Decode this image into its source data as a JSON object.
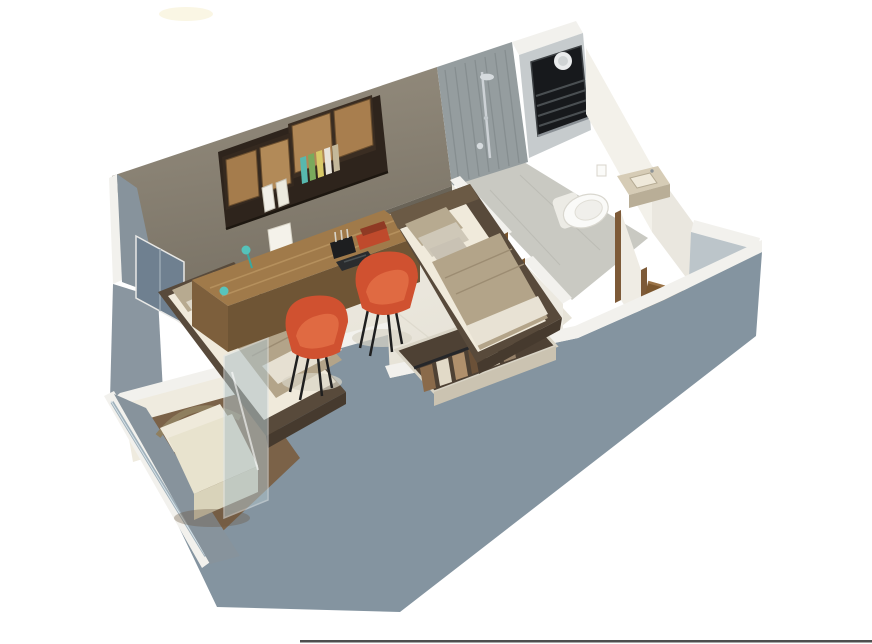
{
  "scene": {
    "type": "3d-isometric-room-render",
    "description_names": [
      "exterior-walls",
      "back-wall",
      "shower-area",
      "ac-vent-unit",
      "bathroom",
      "toilet",
      "wash-basin",
      "entry-door",
      "study-desk",
      "wall-shelving",
      "desk-chair-left",
      "desk-chair-right",
      "bed-right",
      "bed-left",
      "glass-partition",
      "alcove-armchair",
      "open-wardrobe",
      "marble-floor"
    ],
    "palette": {
      "background": "#ffffff",
      "exterior_wall": "#8494a0",
      "exterior_wall_light": "#bcc5ca",
      "wall_top": "#f2f1ed",
      "interior_wall": "#8c8476",
      "floor_marble": "#efece3",
      "bathroom_floor": "#c9c9c2",
      "shower_tile": "#959d9f",
      "ac_unit": "#17191c",
      "wood_desk": "#a07a4a",
      "wood_desk_front": "#6f5535",
      "wood_cabinet": "#b08756",
      "frame_dark": "#2e241c",
      "chair_orange": "#d05130",
      "blanket_beige": "#b3a489",
      "mattress_white": "#f0eadb",
      "pillow_beige": "#b7aa90",
      "bed_frame": "#584a3b",
      "door_wood": "#7b572f",
      "lamp_teal": "#55c2ba",
      "armchair_cream": "#e8e3ce",
      "glass": "#afc2c8",
      "chrome": "#a9b6bf"
    }
  }
}
